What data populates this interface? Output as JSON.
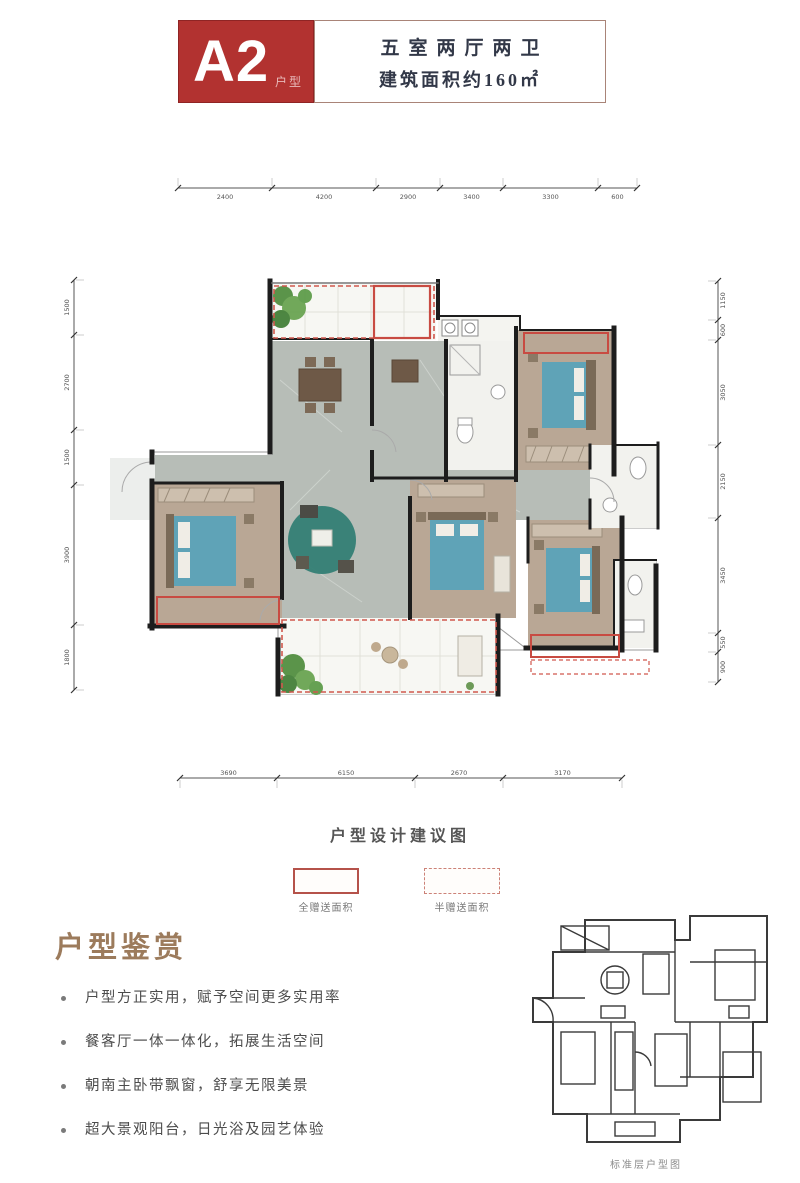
{
  "header": {
    "unit_code": "A2",
    "unit_label": "户型",
    "spec_line1": "五室两厅两卫",
    "spec_line2": "建筑面积约160㎡"
  },
  "floorplan": {
    "caption": "户型设计建议图",
    "legend": [
      {
        "style": "solid",
        "label": "全赠送面积"
      },
      {
        "style": "dashed",
        "label": "半赠送面积"
      }
    ],
    "dimensions": {
      "top": [
        "2400",
        "4200",
        "2900",
        "3400",
        "3300",
        "600"
      ],
      "bottom": [
        "3690",
        "6150",
        "2670",
        "3170"
      ],
      "left": [
        "1500",
        "2700",
        "1500",
        "3900",
        "1800"
      ],
      "right": [
        "1150",
        "600",
        "3050",
        "2150",
        "3450",
        "550",
        "900"
      ]
    }
  },
  "appreciation": {
    "title": "户型鉴赏",
    "bullets": [
      "户型方正实用，赋予空间更多实用率",
      "餐客厅一体一体化，拓展生活空间",
      "朝南主卧带飘窗，舒享无限美景",
      "超大景观阳台，日光浴及园艺体验"
    ]
  },
  "thumbnail": {
    "caption": "标准层户型图"
  },
  "colors": {
    "brand_red": "#b23230",
    "gift_solid": "#c84b42",
    "gift_dashed": "#d98b84",
    "heading_brown": "#9c7b5c",
    "bed_blue": "#5fa3b7",
    "floor_marble": "#b7bdb7",
    "floor_wood": "#b9a795"
  }
}
